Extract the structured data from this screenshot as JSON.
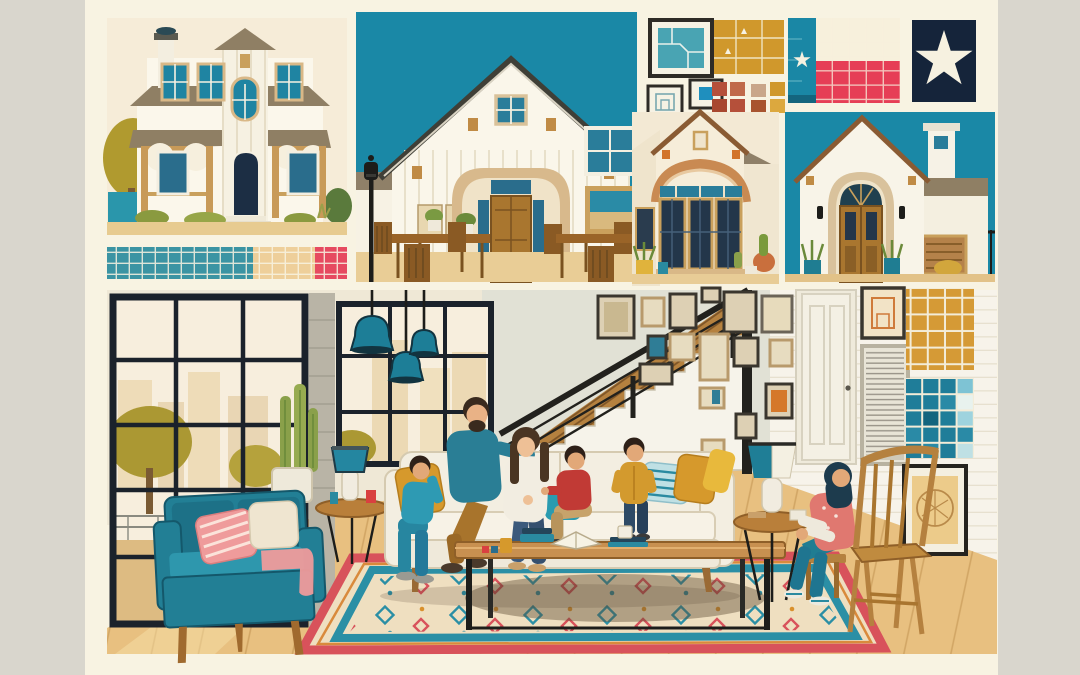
{
  "meta": {
    "type": "illustration-collage",
    "description": "Flat-style illustration collage of Texas homes: a two-story farmhouse, a board-and-batten house with outdoor dining, map prints, Texas-flag tile mosaics, two stucco houses, and a large sunlit living room where a family of five gathers on a cream sofa while a woman in a hijab sits beside a wooden chair."
  },
  "panels": [
    {
      "name": "farmhouse-exterior",
      "description": "Two-story white farmhouse with taupe metal roof, teal windows, arched wooden porch, navy front door, olive tree and teal fence; tile swatch strip below in teal, sand and red"
    },
    {
      "name": "dining-courtyard-house",
      "description": "White board-and-batten gabled house under a teal sky with arched brick entry, wooden door, outdoor wooden dining tables, chairs, potted plants and a black street lamp"
    },
    {
      "name": "map-print-collage",
      "description": "Framed teal map, small framed prints, large mustard plat map and small clay, taupe and mustard tile swatches"
    },
    {
      "name": "texas-flag-tiles",
      "description": "Texas flag as a tile mosaic (teal stripe with white star, white over red fields) beside a navy tile with a large white lone star"
    },
    {
      "name": "bay-window-house",
      "description": "Cream stucco house with brick-arched bay window, dark paned windows and potted desert plants"
    },
    {
      "name": "spanish-stucco-house",
      "description": "White Spanish-style house with arched wooden double doors, lantern sconces, tall chimney, wood vent, teal planters and wrought-iron fence"
    },
    {
      "name": "living-room-scene",
      "description": "Living room with black-framed windows, three teal pendant lamps, teal loveseat with striped pink pillow, columnar cactus, cream sofa with father, mother, two boys and a toddler, wooden coffee table with books and mugs, large patterned rug, stair with wood cladding and black cable railing, gallery wall of frames, white panel door, blinds window, mustard and teal tile swatch grids, framed sketch, and a woman in a hijab seated beside a wooden Windsor chair"
    }
  ],
  "people": [
    {
      "name": "father",
      "clothing": "teal shirt, ochre trousers, dark beard"
    },
    {
      "name": "mother",
      "clothing": "white top, blue jeans, long brown hair"
    },
    {
      "name": "boy-red-shirt",
      "clothing": "red t-shirt, khaki pants"
    },
    {
      "name": "toddler",
      "clothing": "mustard cardigan, navy jeans"
    },
    {
      "name": "boy-teal-outfit",
      "clothing": "teal shirt and pants, gray sneakers"
    },
    {
      "name": "woman-hijab",
      "clothing": "dark teal hijab, coral patterned top with white sleeves, teal pants, sneakers"
    }
  ],
  "palette": {
    "outerGray": "#d9d6cd",
    "canvasCream": "#f8f3e2",
    "skyTeal": "#1a88a6",
    "roofTaupe": "#8f7f64",
    "doorNavy": "#1c2e44",
    "swatchTeal": "#3b94a3",
    "swatchSand": "#eecf9a",
    "swatchRed": "#e64a60",
    "flagRed": "#e63e56",
    "flagNavy": "#15243a",
    "mapMustard": "#d0982c",
    "mapTeal": "#49a4b3",
    "wallCream": "#efe8d6",
    "floorWood": "#e8c080",
    "loveseatTeal": "#227f95",
    "sofaCream": "#f3eee1",
    "pillowMustard": "#d6992c",
    "pillowPink": "#ef9b9b",
    "rugField": "#efdfc0",
    "rugRed": "#d8525b",
    "rugTeal": "#2b8fa5",
    "stairWood": "#b5813f",
    "railBlack": "#22211d",
    "pendantTeal": "#1d7e97",
    "gridMustard": "#d59a36",
    "gridTeal": "#1f7d99",
    "dadTeal": "#2a7e95",
    "boyRed": "#c13a35",
    "toddlerMustard": "#d39a2e",
    "hijabNavy": "#1d3b4d",
    "topCoral": "#e07870",
    "chairWood": "#c08b3f",
    "woodTan": "#c08b45",
    "skin": "#e9b286"
  }
}
